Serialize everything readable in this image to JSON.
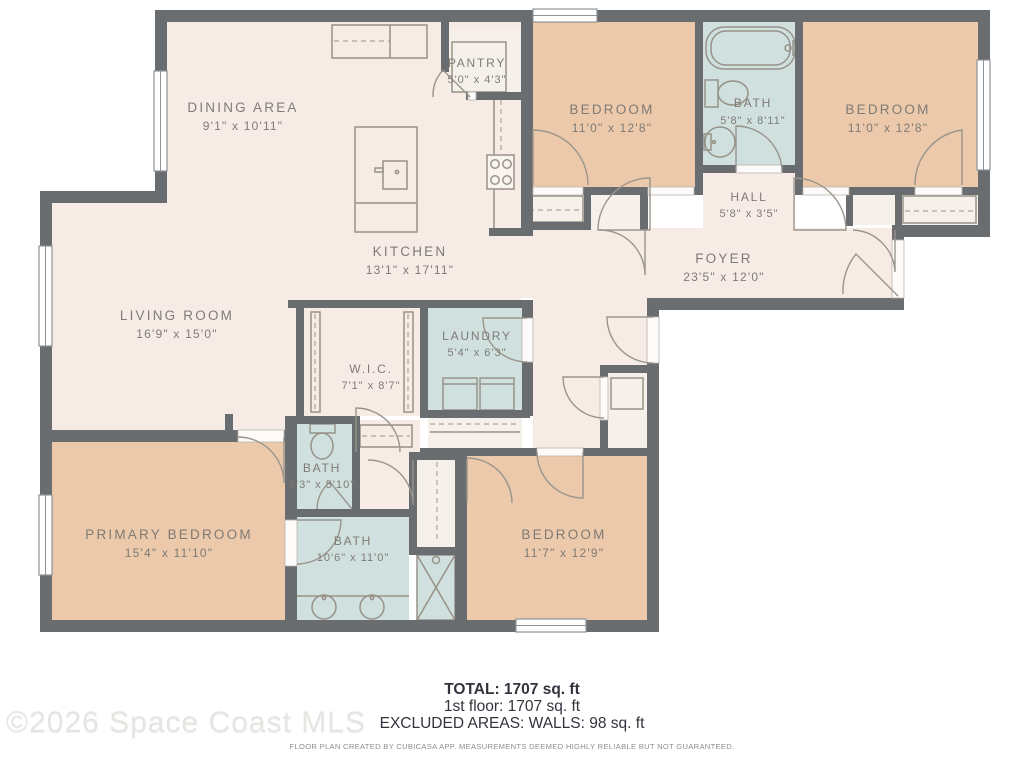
{
  "rooms": [
    {
      "id": "dining-area",
      "name": "DINING AREA",
      "dims": "9'1\" x 10'11\""
    },
    {
      "id": "pantry",
      "name": "PANTRY",
      "dims": "5'0\" x 4'3\""
    },
    {
      "id": "kitchen",
      "name": "KITCHEN",
      "dims": "13'1\" x 17'11\""
    },
    {
      "id": "living-room",
      "name": "LIVING ROOM",
      "dims": "16'9\" x 15'0\""
    },
    {
      "id": "bedroom-top-left",
      "name": "BEDROOM",
      "dims": "11'0\" x 12'8\""
    },
    {
      "id": "bath-top",
      "name": "BATH",
      "dims": "5'8\" x 8'11\""
    },
    {
      "id": "bedroom-top-right",
      "name": "BEDROOM",
      "dims": "11'0\" x 12'8\""
    },
    {
      "id": "hall",
      "name": "HALL",
      "dims": "5'8\" x 3'5\""
    },
    {
      "id": "foyer",
      "name": "FOYER",
      "dims": "23'5\" x 12'0\""
    },
    {
      "id": "laundry",
      "name": "LAUNDRY",
      "dims": "5'4\" x 6'3\""
    },
    {
      "id": "wic",
      "name": "W.I.C.",
      "dims": "7'1\" x 8'7\""
    },
    {
      "id": "bath-powder",
      "name": "BATH",
      "dims": "3'3\" x 5'10\""
    },
    {
      "id": "bath-primary",
      "name": "BATH",
      "dims": "10'6\" x 11'0\""
    },
    {
      "id": "primary-bedroom",
      "name": "PRIMARY BEDROOM",
      "dims": "15'4\" x 11'10\""
    },
    {
      "id": "bedroom-bottom",
      "name": "BEDROOM",
      "dims": "11'7\" x 12'9\""
    }
  ],
  "footer": {
    "total": "TOTAL: 1707 sq. ft",
    "first_floor": "1st floor: 1707 sq. ft",
    "excluded": "EXCLUDED AREAS: WALLS: 98 sq. ft",
    "disclaimer": "FLOOR PLAN CREATED BY CUBICASA APP. MEASUREMENTS DEEMED HIGHLY RELIABLE BUT NOT GUARANTEED."
  },
  "watermark": "©2026 Space Coast MLS",
  "colors": {
    "bedroom_fill": "#ecc9ab",
    "bath_fill": "#cfe0df",
    "floor_fill": "#f6ece5",
    "wall": "#6a6d70",
    "label_text": "#7f7b75"
  }
}
